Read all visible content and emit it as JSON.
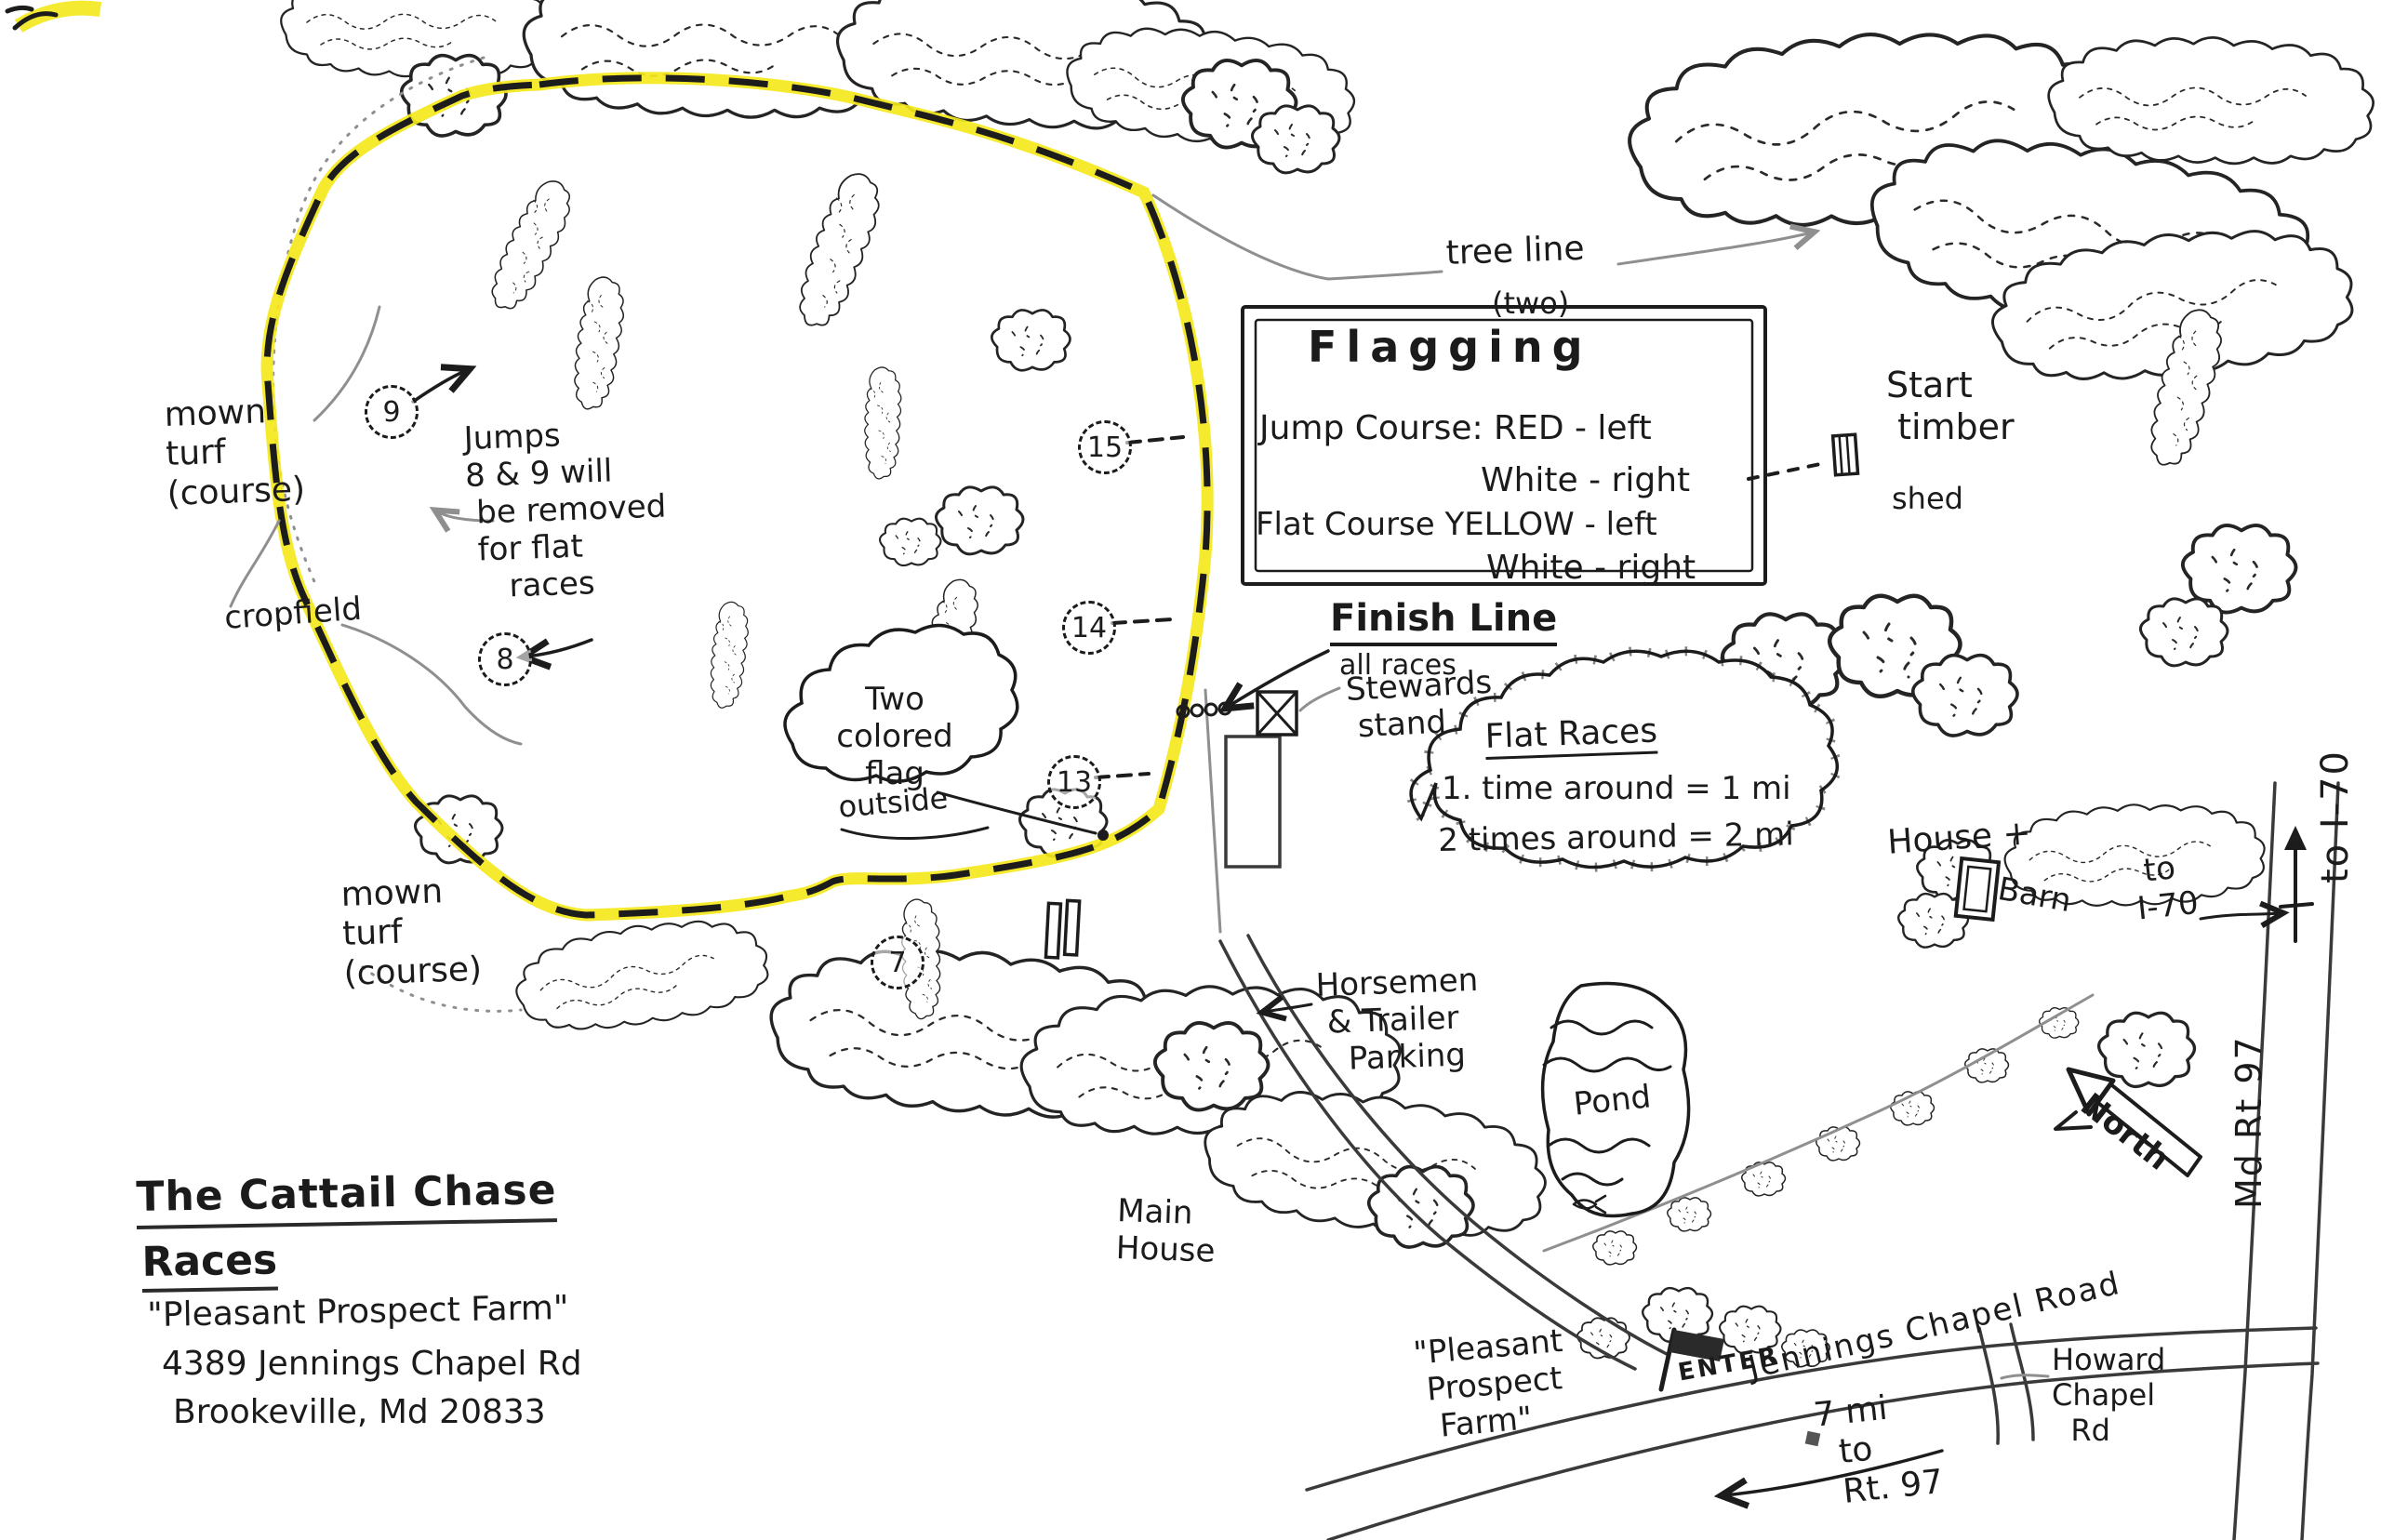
{
  "colors": {
    "ink": "#1c1c1c",
    "pencil": "#8f8f8f",
    "highlight": "#f4e81c",
    "paper": "#ffffff"
  },
  "title_block": {
    "line1": "The Cattail Chase",
    "line2": "Races",
    "line3": "\"Pleasant Prospect Farm\"",
    "line4": "4389 Jennings Chapel Rd",
    "line5": "Brookeville, Md 20833"
  },
  "course": {
    "mown_turf_upper": "mown\nturf\n(course)",
    "mown_turf_lower": "mown\nturf\n(course)",
    "cropfield": "cropfield",
    "jumps_note": "Jumps\n8 & 9 will\n be removed\n for flat\n    races",
    "flag_cloud": "Two\ncolored\nflag",
    "flag_cloud_sub": "outside",
    "jumps": [
      {
        "label": "9"
      },
      {
        "label": "8"
      },
      {
        "label": "15"
      },
      {
        "label": "14"
      },
      {
        "label": "13"
      },
      {
        "label": "7"
      }
    ]
  },
  "flagging_box": {
    "title": "Flagging",
    "jump_line1": "Jump Course: RED - left",
    "jump_line2": "White - right",
    "flat_line1": "Flat Course YELLOW - left",
    "flat_line2": "White - right"
  },
  "tree_line": {
    "label": "tree line",
    "sub": "(two)"
  },
  "start_area": {
    "label": "Start\n timber",
    "shed": "shed"
  },
  "finish_area": {
    "label": "Finish Line",
    "sub": "all races",
    "stewards": "Stewards\n stand"
  },
  "flat_races": {
    "title": "Flat Races",
    "line1": "1. time around = 1 mi",
    "line2": "2 times around = 2 mi"
  },
  "landmarks": {
    "house": "House +",
    "barn": "Barn",
    "to_i70": " to\nI-70",
    "pond": "Pond",
    "main_house": "Main\nHouse",
    "horsemen": "Horsemen\n & Trailer\n   Parking"
  },
  "roads": {
    "md_rt_97": "Md Rt 97",
    "to_i70_top": "to I-70",
    "north": "North",
    "jennings": "Jennings Chapel Road",
    "howard": "Howard\nChapel\n  Rd",
    "enter": "ENTER",
    "farm_sign": "\"Pleasant\n Prospect\n  Farm\"",
    "miles_note": "7 mi\n  to\n  Rt. 97"
  }
}
